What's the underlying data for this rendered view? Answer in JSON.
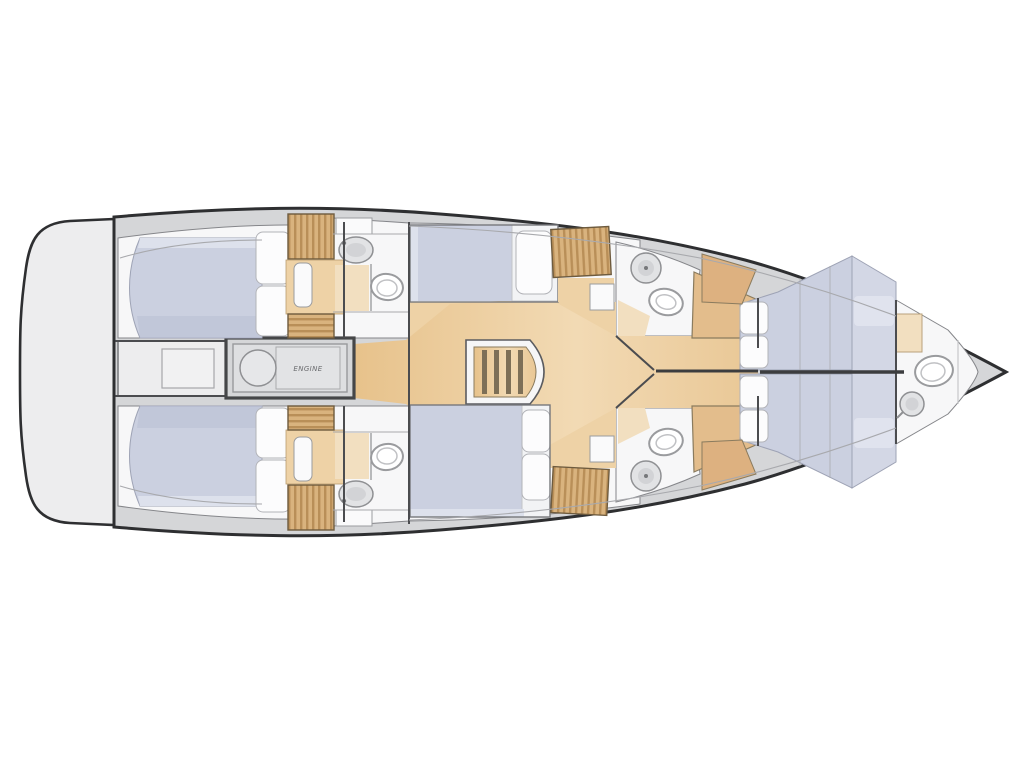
{
  "document": {
    "type": "yacht-deck-plan",
    "description": "Top-down interior layout plan of a sailing yacht hull, bow pointing right, drawn on a white background"
  },
  "labels": {
    "engine": "ENGINE"
  },
  "colors": {
    "hull_outline": "#2e2f31",
    "deck": "#d5d6d8",
    "platform": "#ededee",
    "room": "#f7f7f8",
    "berth": "#cbd0e0",
    "berth_dark": "#b9bfd3",
    "pillow": "#fcfcfd",
    "wood_floor": "#eac893",
    "wood_furniture": "#d9b37e",
    "wood_stripe": "#b98f58",
    "beige": "#f2dfc0",
    "fixture": "#e2e3e5"
  },
  "rooms": [
    {
      "name": "stern-swim-platform",
      "fixtures": []
    },
    {
      "name": "aft-cabin-port",
      "fixtures": [
        "double-berth",
        "pillows",
        "wardrobe",
        "vanity-seat",
        "storage-chest"
      ]
    },
    {
      "name": "aft-head-port",
      "fixtures": [
        "washbasin",
        "toilet",
        "cabinet"
      ]
    },
    {
      "name": "aft-cabin-starboard",
      "fixtures": [
        "double-berth",
        "pillows",
        "wardrobe",
        "vanity-seat",
        "storage-chest"
      ]
    },
    {
      "name": "aft-head-starboard",
      "fixtures": [
        "washbasin",
        "toilet",
        "cabinet"
      ]
    },
    {
      "name": "engine-room",
      "fixtures": [
        "engine-block"
      ]
    },
    {
      "name": "saloon",
      "fixtures": [
        "companionway-stairs",
        "wood-sole"
      ]
    },
    {
      "name": "mid-cabin-port",
      "fixtures": [
        "double-berth",
        "pillow",
        "wardrobe",
        "cabinet"
      ]
    },
    {
      "name": "mid-head-port",
      "fixtures": [
        "washbasin",
        "toilet"
      ]
    },
    {
      "name": "mid-cabin-starboard",
      "fixtures": [
        "double-berth",
        "pillows",
        "wardrobe",
        "cabinet"
      ]
    },
    {
      "name": "mid-head-starboard",
      "fixtures": [
        "washbasin",
        "toilet"
      ]
    },
    {
      "name": "forward-cabin",
      "fixtures": [
        "v-berth",
        "pillows",
        "side-cabinet"
      ]
    },
    {
      "name": "forward-head",
      "fixtures": [
        "toilet",
        "washbasin"
      ]
    }
  ]
}
